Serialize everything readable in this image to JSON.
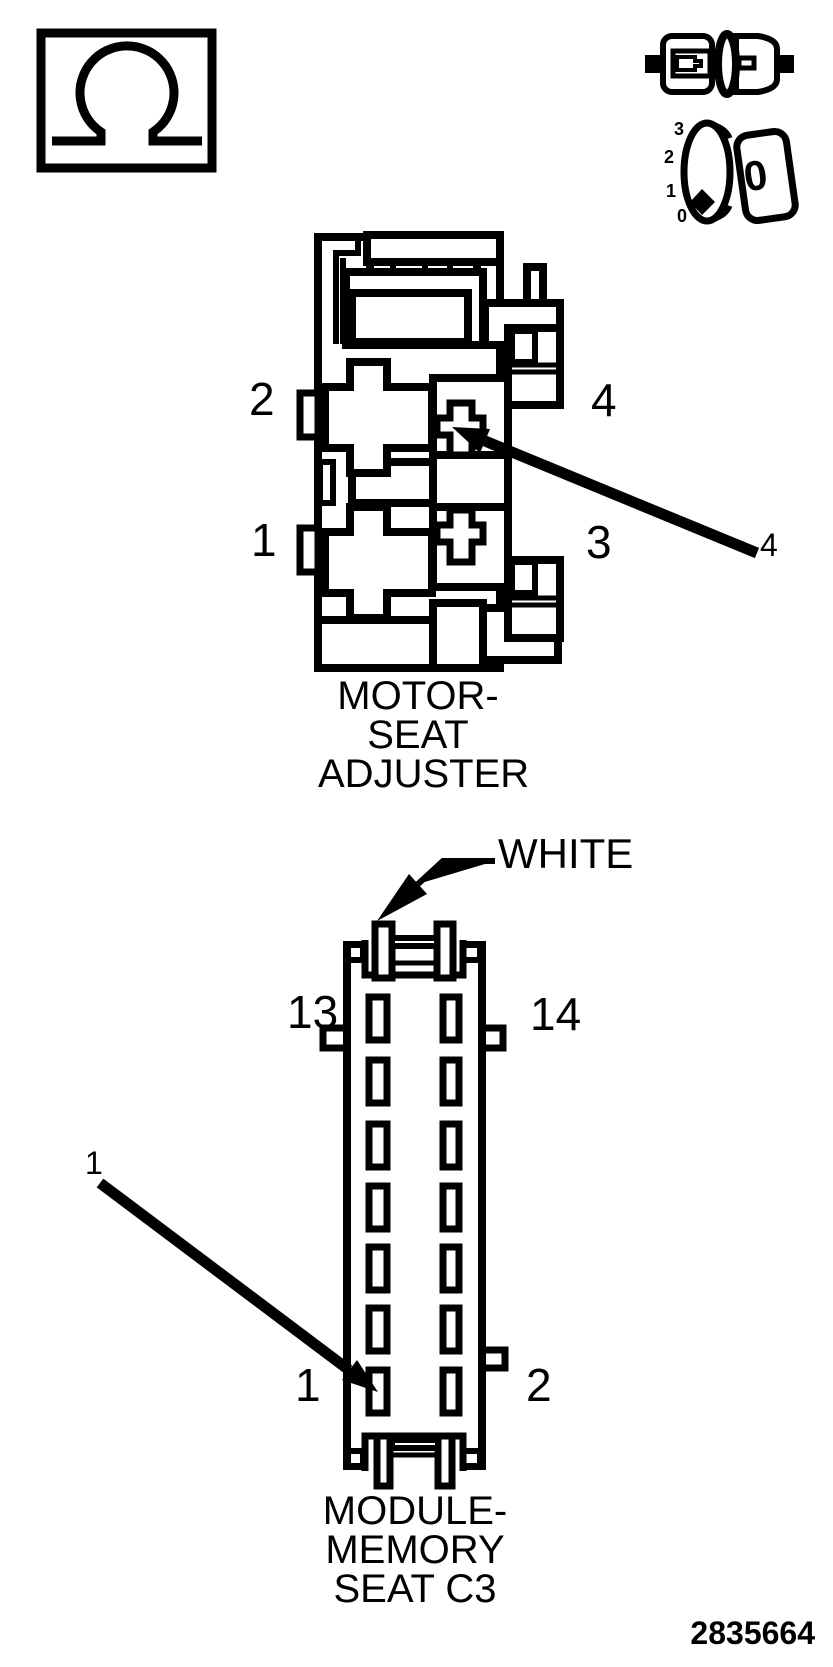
{
  "page": {
    "background": "#ffffff",
    "ink": "#000000",
    "figure_number": "2835664"
  },
  "ohmmeter": {
    "symbol": "ohmmeter"
  },
  "ignition_switch": {
    "positions": {
      "p3": "3",
      "p2": "2",
      "p1": "1",
      "p0": "0"
    },
    "key_label": "0"
  },
  "motor_connector": {
    "title_line1": "MOTOR-",
    "title_line2": "SEAT",
    "title_line3": "ADJUSTER",
    "pin_top_left": "2",
    "pin_bottom_left": "1",
    "pin_top_right": "4",
    "pin_bottom_right": "3",
    "callout": "4"
  },
  "module_connector": {
    "title_line1": "MODULE-",
    "title_line2": "MEMORY",
    "title_line3": "SEAT C3",
    "pin_top_left": "13",
    "pin_top_right": "14",
    "pin_bottom_left": "1",
    "pin_bottom_right": "2",
    "callout": "1",
    "wire_color_label": "WHITE"
  }
}
